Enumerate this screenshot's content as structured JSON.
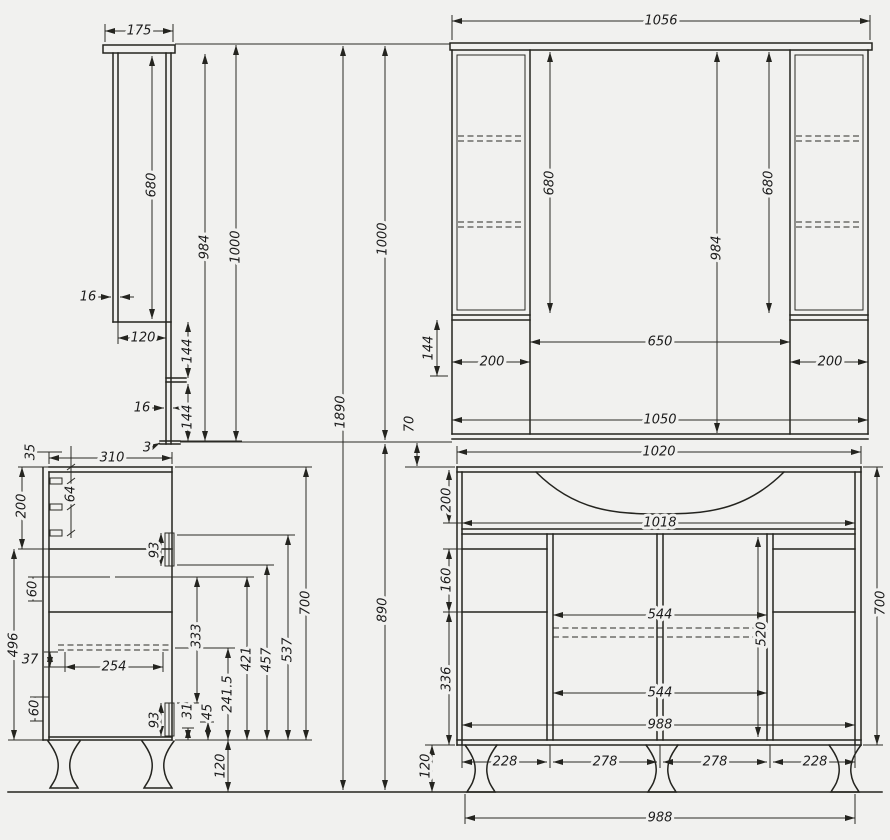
{
  "drawing": "bathroom-vanity-technical-drawing",
  "views": {
    "mirror_side": {
      "depth175": "175",
      "door680": "680",
      "inner984": "984",
      "total1000": "1000",
      "thick16_top": "16",
      "depth120": "120",
      "seg144_top": "144",
      "thick16_bot": "16",
      "seg144_bot": "144",
      "thick3": "3"
    },
    "mirror_front": {
      "width1056": "1056",
      "total1890": "1890",
      "height1000": "1000",
      "lower890": "890",
      "gap70": "70",
      "door680_left": "680",
      "inner984": "984",
      "door680_right": "680",
      "seg144": "144",
      "box200_left": "200",
      "span650": "650",
      "box200_right": "200",
      "width1050": "1050"
    },
    "base_side": {
      "top35": "35",
      "depth310": "310",
      "pitch64": "64",
      "h200": "200",
      "h60_upper": "60",
      "h496": "496",
      "h37": "37",
      "h60_lower": "60",
      "shelf254": "254",
      "handle93_upper": "93",
      "h333": "333",
      "h421": "421",
      "h457": "457",
      "h537": "537",
      "height700": "700",
      "h241_5": "241.5",
      "h45": "45",
      "h31": "31",
      "handle93_lower": "93",
      "legs120": "120"
    },
    "base_front": {
      "width1020": "1020",
      "basin200": "200",
      "inner1018": "1018",
      "drawer160": "160",
      "h336": "336",
      "span544_top": "544",
      "h520": "520",
      "span544_bot": "544",
      "inner988": "988",
      "door228_left": "228",
      "door278_left": "278",
      "door278_right": "278",
      "door228_right": "228",
      "legs120": "120",
      "height700": "700",
      "overall988": "988"
    }
  }
}
